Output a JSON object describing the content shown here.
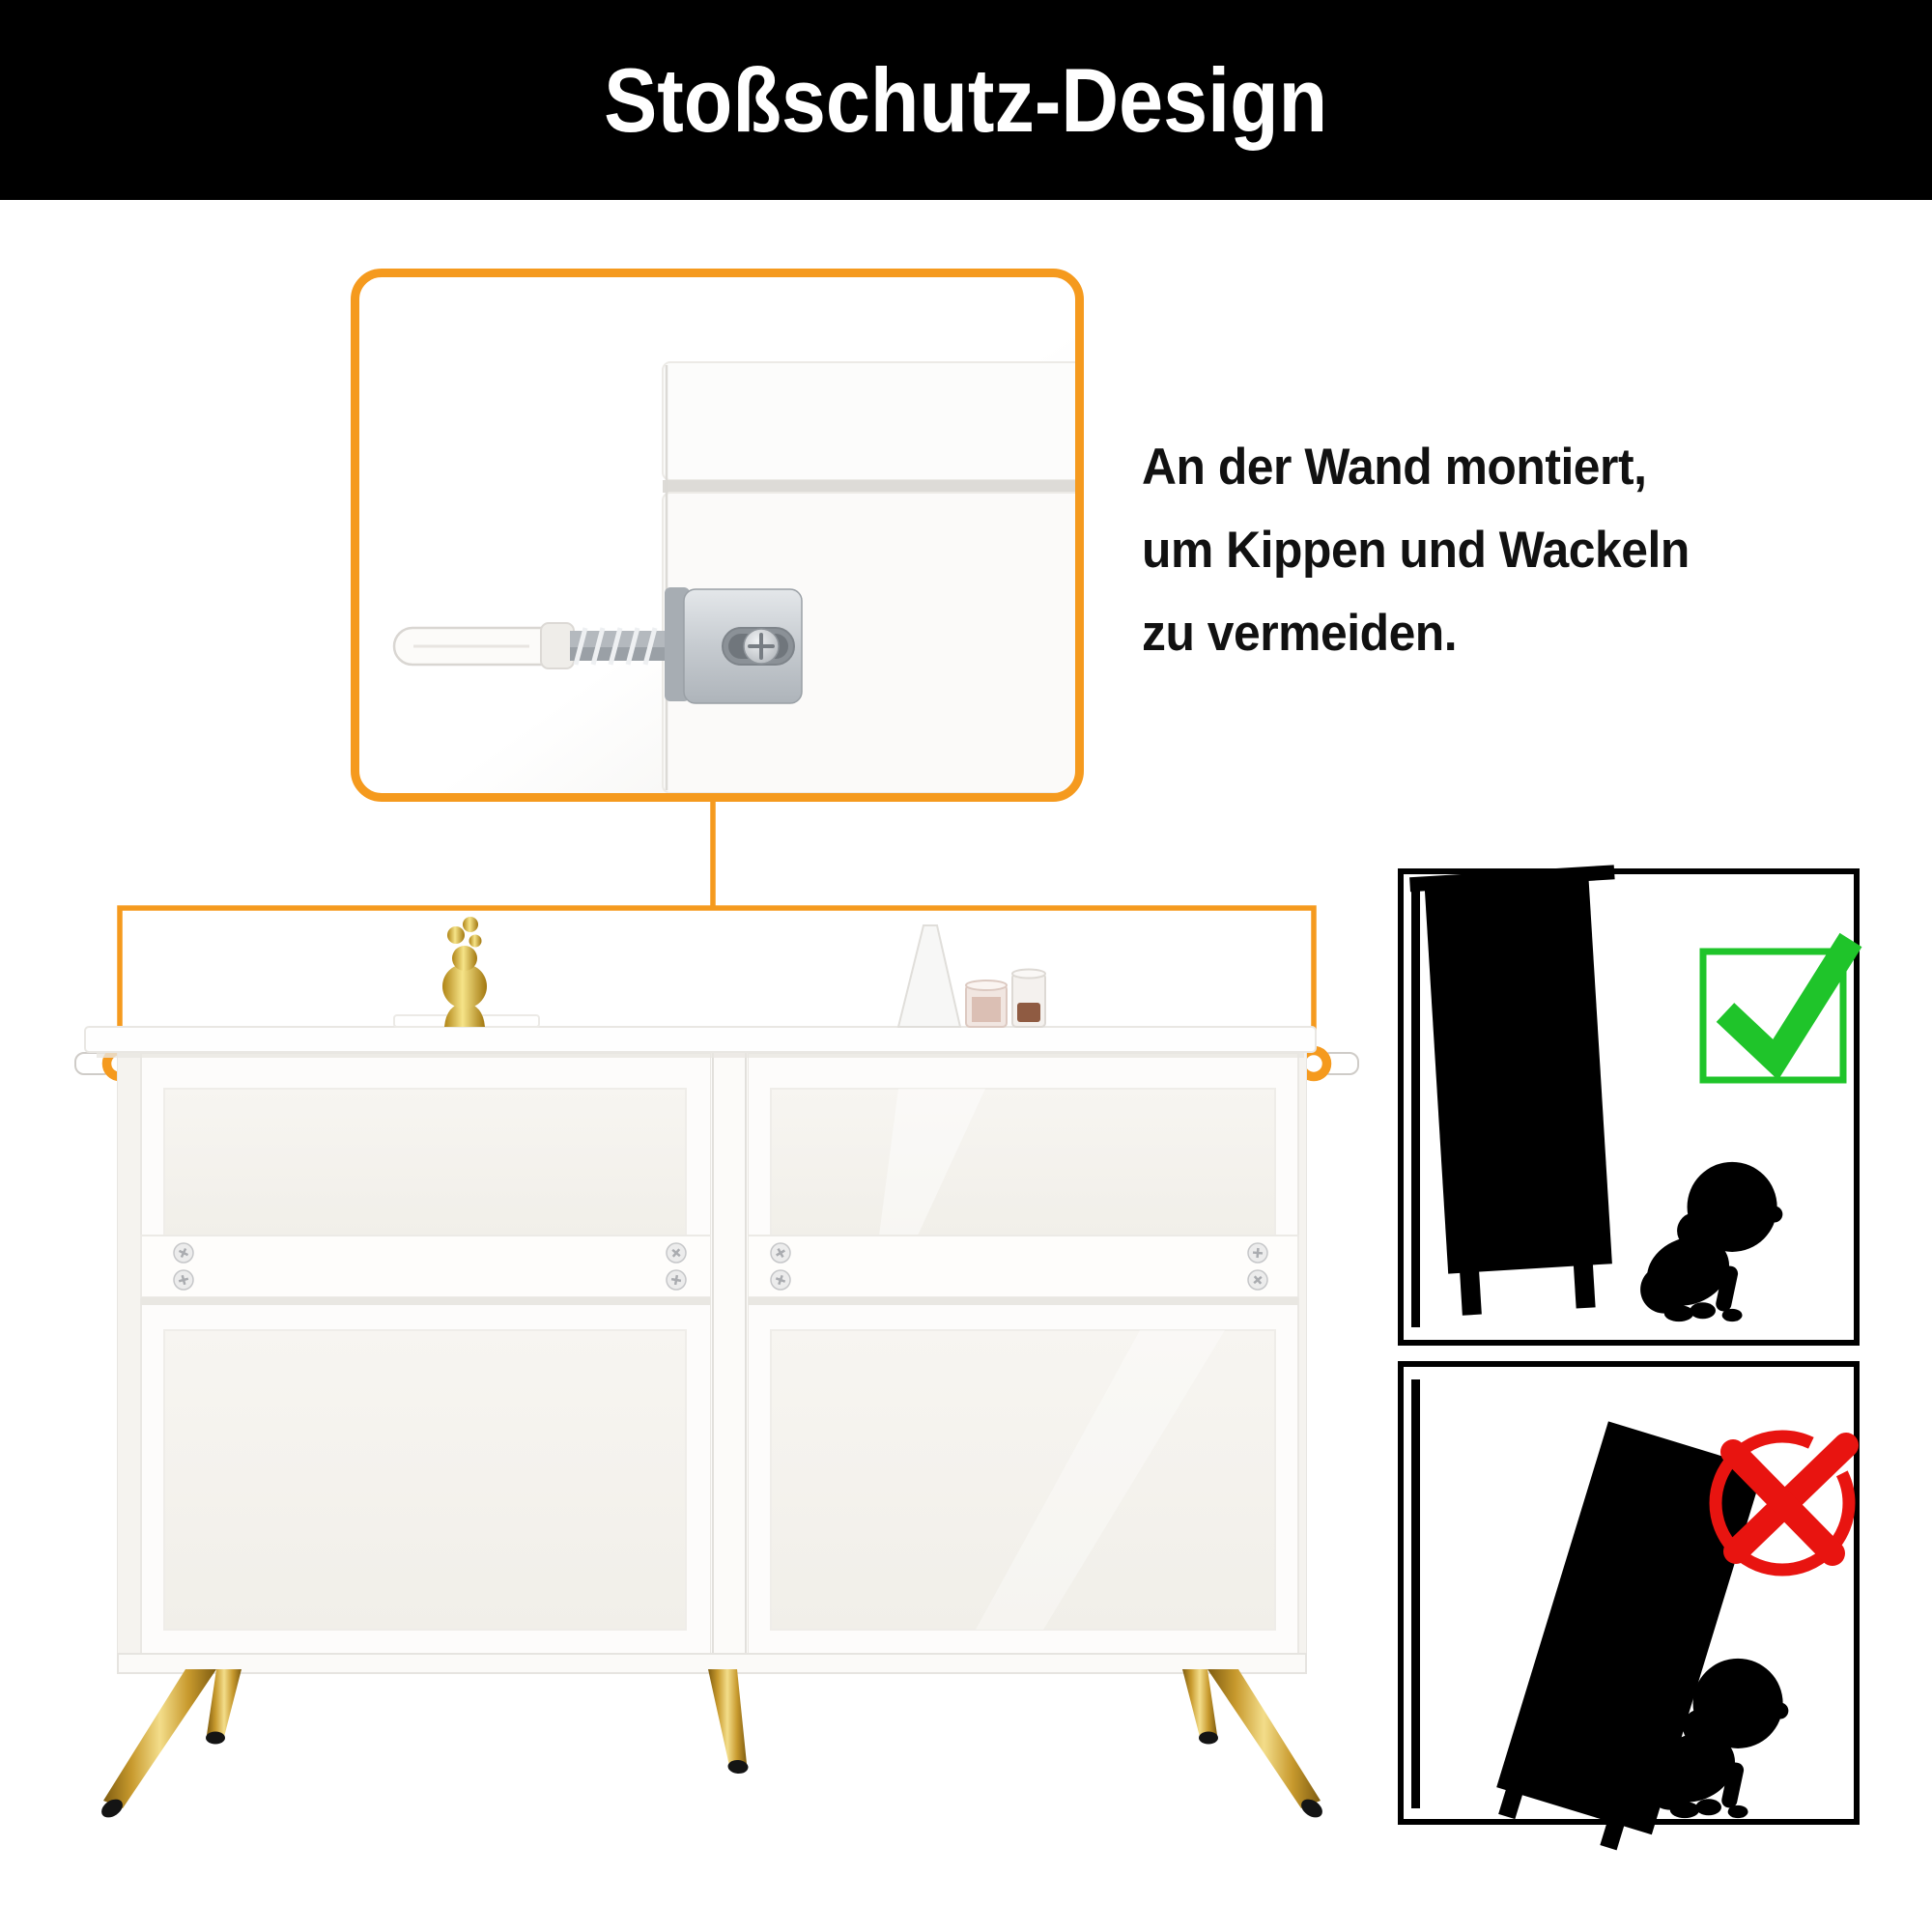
{
  "title": "Stoßschutz-Design",
  "caption": {
    "line1": "An der Wand montiert,",
    "line2": "um Kippen und Wackeln",
    "line3": "zu vermeiden."
  },
  "colors": {
    "accent": "#F59A1E",
    "green": "#1FC42A",
    "red": "#E81410",
    "banner": "#000000",
    "text": "#111111",
    "gold": "#C89A2E",
    "silver": "#B9BEC3"
  },
  "icons": {
    "correct": "checkmark-icon",
    "incorrect": "cross-icon",
    "baby": "baby-silhouette-icon",
    "anchor": "wall-anchor-icon",
    "bracket": "l-bracket-icon"
  }
}
